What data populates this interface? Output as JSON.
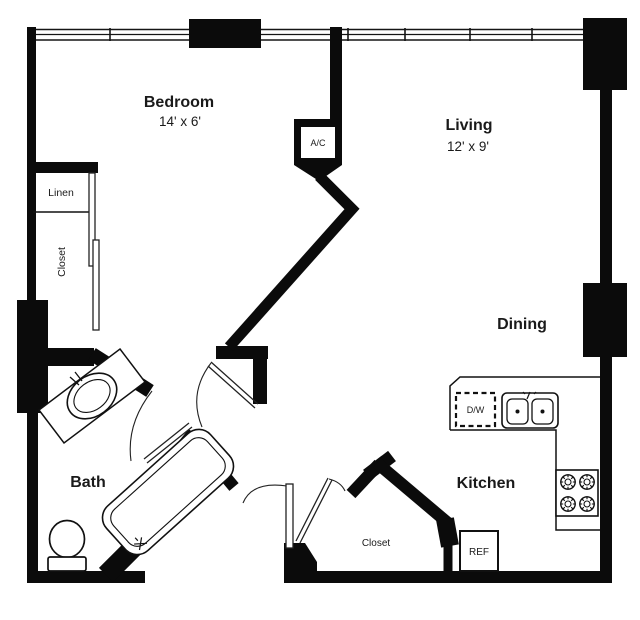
{
  "plan": {
    "title": "Apartment floor plan",
    "rooms": {
      "bedroom": {
        "name": "Bedroom",
        "dims": "14' x 6'"
      },
      "living": {
        "name": "Living",
        "dims": "12' x 9'"
      },
      "dining": {
        "name": "Dining"
      },
      "kitchen": {
        "name": "Kitchen"
      },
      "bath": {
        "name": "Bath"
      }
    },
    "closets": {
      "linen": "Linen",
      "bedroom_closet": "Closet",
      "entry_closet": "Closet"
    },
    "appliances": {
      "ac": "A/C",
      "dishwasher": "D/W",
      "refrigerator": "REF"
    },
    "colors": {
      "wall": "#0b0b0b",
      "text": "#1a1a1a",
      "background": "#ffffff"
    }
  }
}
